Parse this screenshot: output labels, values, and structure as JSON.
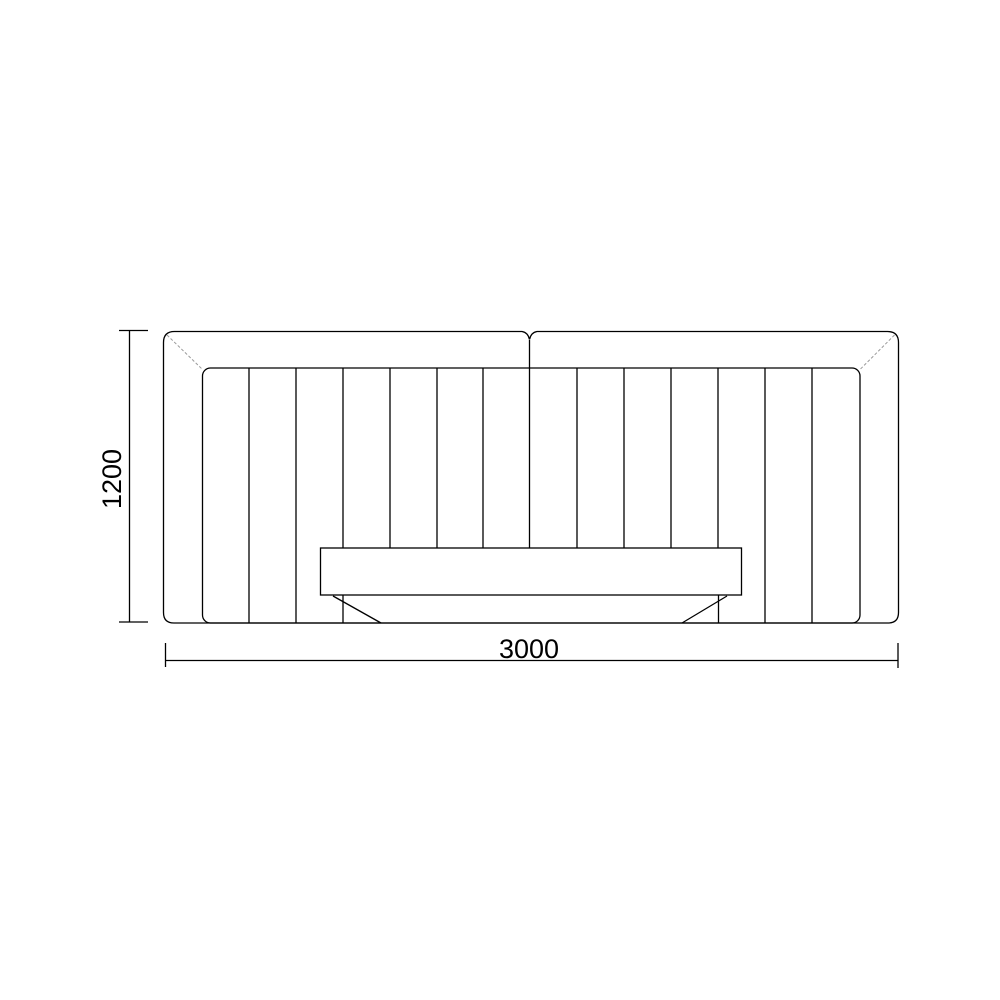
{
  "drawing": {
    "background_color": "#ffffff",
    "line_color": "#000000",
    "crease_color": "#9b9b9b"
  },
  "dimensions": {
    "height": {
      "label": "1200"
    },
    "width": {
      "label": "3000"
    }
  }
}
